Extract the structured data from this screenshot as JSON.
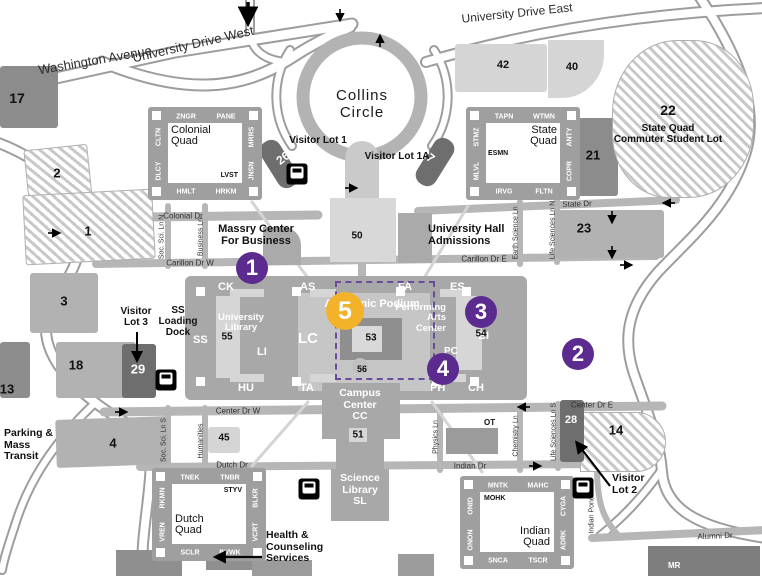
{
  "colors": {
    "road": "#b6b6b6",
    "road_casing": "#9d9d9d",
    "lot_gray": "#b2b2b2",
    "lot_dark": "#8c8c8c",
    "lot_darker": "#6e6e6e",
    "lot_light": "#d5d5d5",
    "quad": "#9f9f9f",
    "podium": "#a8a8a8",
    "podium_inner": "#c6c6c6",
    "marker_purple": "#5b2b8f",
    "marker_yellow": "#f2b32b",
    "dash": "#6a4ba0"
  },
  "road_labels": [
    {
      "text": "Washington Avenue",
      "x": 95,
      "y": 60,
      "rot": -10,
      "size": 13
    },
    {
      "text": "University Drive West",
      "x": 193,
      "y": 44,
      "rot": -13,
      "size": 13
    },
    {
      "text": "University Drive East",
      "x": 517,
      "y": 13,
      "rot": -6,
      "size": 12
    },
    {
      "text": "Colonial Dr",
      "x": 183,
      "y": 216,
      "rot": 0,
      "size": 8
    },
    {
      "text": "State Dr",
      "x": 577,
      "y": 204,
      "rot": -2,
      "size": 8
    },
    {
      "text": "Carillon Dr W",
      "x": 190,
      "y": 263,
      "rot": 0,
      "size": 8
    },
    {
      "text": "Carillon Dr E",
      "x": 484,
      "y": 259,
      "rot": 0,
      "size": 8
    },
    {
      "text": "Center Dr W",
      "x": 238,
      "y": 411,
      "rot": 0,
      "size": 8
    },
    {
      "text": "Center Dr E",
      "x": 592,
      "y": 405,
      "rot": 0,
      "size": 8
    },
    {
      "text": "Dutch Dr",
      "x": 232,
      "y": 465,
      "rot": 0,
      "size": 8
    },
    {
      "text": "Indian Dr",
      "x": 470,
      "y": 466,
      "rot": 0,
      "size": 8
    },
    {
      "text": "Alumni Dr",
      "x": 715,
      "y": 536,
      "rot": -2,
      "size": 8
    },
    {
      "text": "Soc. Sci. Ln N",
      "x": 162,
      "y": 237,
      "rot": -90,
      "size": 7
    },
    {
      "text": "Business Ln",
      "x": 201,
      "y": 237,
      "rot": -90,
      "size": 7
    },
    {
      "text": "Earth Science Ln",
      "x": 516,
      "y": 233,
      "rot": -90,
      "size": 7
    },
    {
      "text": "Life Sciences Ln N",
      "x": 553,
      "y": 230,
      "rot": -90,
      "size": 7
    },
    {
      "text": "Soc. Sci. Ln S",
      "x": 164,
      "y": 440,
      "rot": -90,
      "size": 7
    },
    {
      "text": "Humanities",
      "x": 201,
      "y": 441,
      "rot": -90,
      "size": 7
    },
    {
      "text": "Physics Ln",
      "x": 436,
      "y": 437,
      "rot": -90,
      "size": 7
    },
    {
      "text": "Chemistry Ln",
      "x": 516,
      "y": 436,
      "rot": -90,
      "size": 7
    },
    {
      "text": "Life Sciences Ln S",
      "x": 554,
      "y": 432,
      "rot": -90,
      "size": 7
    },
    {
      "text": "Indian Pond Ln",
      "x": 592,
      "y": 510,
      "rot": -90,
      "size": 7
    }
  ],
  "area_labels": [
    {
      "id": "collins-circle",
      "lines": [
        "Collins",
        "Circle"
      ],
      "x": 362,
      "y": 88,
      "size": 15,
      "weight": 500,
      "align": "center",
      "color": "#1a1a1a",
      "ls": 1
    },
    {
      "id": "visitor-lot-1",
      "lines": [
        "Visitor Lot 1"
      ],
      "x": 318,
      "y": 135,
      "size": 10,
      "weight": 700,
      "align": "center",
      "color": "#111"
    },
    {
      "id": "visitor-lot-1a",
      "lines": [
        "Visitor Lot 1A"
      ],
      "x": 397,
      "y": 151,
      "size": 10,
      "weight": 700,
      "align": "center",
      "color": "#111"
    },
    {
      "id": "massry-center",
      "lines": [
        "Massry Center",
        "For Business"
      ],
      "x": 256,
      "y": 223,
      "size": 11,
      "weight": 700,
      "align": "center",
      "color": "#111"
    },
    {
      "id": "university-hall",
      "lines": [
        "University Hall",
        "Admissions"
      ],
      "x": 428,
      "y": 223,
      "size": 11,
      "weight": 700,
      "align": "left",
      "color": "#111"
    },
    {
      "id": "campus-center",
      "lines": [
        "Campus",
        "Center",
        "CC"
      ],
      "x": 360,
      "y": 388,
      "size": 10.5,
      "weight": 700,
      "align": "center",
      "color": "#fff"
    },
    {
      "id": "science-library",
      "lines": [
        "Science",
        "Library",
        "SL"
      ],
      "x": 360,
      "y": 473,
      "size": 10.5,
      "weight": 700,
      "align": "center",
      "color": "#fff"
    },
    {
      "id": "health-counseling",
      "lines": [
        "Health &",
        "Counseling",
        "Services"
      ],
      "x": 266,
      "y": 530,
      "size": 10.5,
      "weight": 700,
      "align": "left",
      "color": "#111"
    },
    {
      "id": "parking-mass-transit",
      "lines": [
        "Parking &",
        "Mass",
        "Transit"
      ],
      "x": 4,
      "y": 428,
      "size": 10.5,
      "weight": 700,
      "align": "left",
      "color": "#111"
    },
    {
      "id": "visitor-lot-3",
      "lines": [
        "Visitor",
        "Lot 3"
      ],
      "x": 136,
      "y": 306,
      "size": 10,
      "weight": 700,
      "align": "center",
      "color": "#111"
    },
    {
      "id": "ss-loading-dock",
      "lines": [
        "SS",
        "Loading",
        "Dock"
      ],
      "x": 178,
      "y": 305,
      "size": 10,
      "weight": 700,
      "align": "center",
      "color": "#111"
    },
    {
      "id": "visitor-lot-2",
      "lines": [
        "Visitor",
        "Lot 2"
      ],
      "x": 612,
      "y": 473,
      "size": 10.5,
      "weight": 700,
      "align": "left",
      "color": "#111"
    },
    {
      "id": "state-quad-commuter-lot",
      "lines": [
        "State Quad",
        "Commuter Student Lot"
      ],
      "x": 668,
      "y": 123,
      "size": 10,
      "weight": 700,
      "align": "center",
      "color": "#111"
    },
    {
      "id": "ot-building",
      "lines": [
        "OT"
      ],
      "x": 484,
      "y": 419,
      "size": 8,
      "weight": 700,
      "align": "left",
      "color": "#111"
    },
    {
      "id": "mr-building",
      "lines": [
        "MR"
      ],
      "x": 668,
      "y": 562,
      "size": 8,
      "weight": 700,
      "align": "left",
      "color": "#fff"
    },
    {
      "id": "academic-podium",
      "lines": [
        "Academic Podium"
      ],
      "x": 372,
      "y": 298,
      "size": 11,
      "weight": 700,
      "align": "center",
      "color": "#fff"
    },
    {
      "id": "performing-arts",
      "lines": [
        "Performing",
        "Arts",
        "Center"
      ],
      "x": 446,
      "y": 303,
      "size": 9.5,
      "weight": 700,
      "align": "right",
      "color": "#fff"
    },
    {
      "id": "pc-code",
      "lines": [
        "PC"
      ],
      "x": 444,
      "y": 346,
      "size": 10,
      "weight": 700,
      "align": "left",
      "color": "#fff"
    },
    {
      "id": "university-library",
      "lines": [
        "University",
        "Library"
      ],
      "x": 241,
      "y": 313,
      "size": 9.5,
      "weight": 700,
      "align": "center",
      "color": "#fff"
    }
  ],
  "numbers": [
    {
      "t": "17",
      "x": 17,
      "y": 98,
      "s": 14
    },
    {
      "t": "2",
      "x": 57,
      "y": 173,
      "s": 13
    },
    {
      "t": "1",
      "x": 88,
      "y": 231,
      "s": 13
    },
    {
      "t": "3",
      "x": 64,
      "y": 301,
      "s": 13
    },
    {
      "t": "13",
      "x": 7,
      "y": 389,
      "s": 13
    },
    {
      "t": "18",
      "x": 76,
      "y": 365,
      "s": 13
    },
    {
      "t": "29",
      "x": 138,
      "y": 369,
      "s": 13,
      "c": "#fff"
    },
    {
      "t": "4",
      "x": 113,
      "y": 443,
      "s": 13
    },
    {
      "t": "45",
      "x": 224,
      "y": 438,
      "s": 10
    },
    {
      "t": "42",
      "x": 503,
      "y": 65,
      "s": 11
    },
    {
      "t": "40",
      "x": 572,
      "y": 67,
      "s": 11
    },
    {
      "t": "21",
      "x": 593,
      "y": 155,
      "s": 13
    },
    {
      "t": "22",
      "x": 668,
      "y": 110,
      "s": 14
    },
    {
      "t": "23",
      "x": 584,
      "y": 228,
      "s": 13
    },
    {
      "t": "14",
      "x": 616,
      "y": 430,
      "s": 13
    },
    {
      "t": "28",
      "x": 571,
      "y": 420,
      "s": 11,
      "c": "#fff"
    },
    {
      "t": "26",
      "x": 283,
      "y": 158,
      "s": 12,
      "c": "#fff",
      "rot": -38
    },
    {
      "t": "27",
      "x": 428,
      "y": 156,
      "s": 12,
      "c": "#fff",
      "rot": 38
    },
    {
      "t": "50",
      "x": 357,
      "y": 236,
      "s": 10
    },
    {
      "t": "51",
      "x": 358,
      "y": 435,
      "s": 10
    },
    {
      "t": "53",
      "x": 371,
      "y": 338,
      "s": 10
    },
    {
      "t": "54",
      "x": 481,
      "y": 334,
      "s": 10
    },
    {
      "t": "55",
      "x": 227,
      "y": 337,
      "s": 10
    },
    {
      "t": "56",
      "x": 362,
      "y": 369,
      "s": 9
    }
  ],
  "quads": [
    {
      "id": "colonial-quad",
      "name": "Colonial Quad",
      "x": 148,
      "y": 107,
      "top": [
        "ZNGR",
        "PANE"
      ],
      "left": [
        "CLTN",
        "DLCY"
      ],
      "right": [
        "MRRS",
        "JNSN"
      ],
      "bottom": [
        "HMLT",
        "HRKM"
      ],
      "inner_code": "LVST",
      "name_pos": "tl",
      "code_pos": "br"
    },
    {
      "id": "state-quad",
      "name": "State Quad",
      "x": 466,
      "y": 107,
      "top": [
        "TAPN",
        "WTMN"
      ],
      "left": [
        "STMZ",
        "MLVL"
      ],
      "right": [
        "ANTY",
        "COPR"
      ],
      "bottom": [
        "IRVG",
        "FLTN"
      ],
      "inner_code": "ESMN",
      "name_pos": "tr",
      "code_pos": "ml"
    },
    {
      "id": "dutch-quad",
      "name": "Dutch Quad",
      "x": 152,
      "y": 468,
      "top": [
        "TNEK",
        "TNBR"
      ],
      "left": [
        "RKMN",
        "VREN"
      ],
      "right": [
        "BLKR",
        "VCRT"
      ],
      "bottom": [
        "SCLR",
        "BVWK"
      ],
      "inner_code": "STYV",
      "name_pos": "bl",
      "code_pos": "tr"
    },
    {
      "id": "indian-quad",
      "name": "Indian Quad",
      "x": 460,
      "y": 476,
      "top": [
        "MNTK",
        "MAHC"
      ],
      "left": [
        "ONID",
        "ONON"
      ],
      "right": [
        "CYGA",
        "ADRK"
      ],
      "bottom": [
        "SNCA",
        "TSCR"
      ],
      "inner_code": "MOHK",
      "name_pos": "br",
      "code_pos": "tl"
    }
  ],
  "podium_labels": [
    {
      "t": "CK",
      "x": 218,
      "y": 281
    },
    {
      "t": "AS",
      "x": 300,
      "y": 281
    },
    {
      "t": "FA",
      "x": 398,
      "y": 281
    },
    {
      "t": "ES",
      "x": 450,
      "y": 281
    },
    {
      "t": "SS",
      "x": 193,
      "y": 334
    },
    {
      "t": "LC",
      "x": 298,
      "y": 330,
      "s": 15
    },
    {
      "t": "BI",
      "x": 478,
      "y": 330
    },
    {
      "t": "LI",
      "x": 257,
      "y": 346
    },
    {
      "t": "HU",
      "x": 238,
      "y": 382
    },
    {
      "t": "TA",
      "x": 300,
      "y": 382
    },
    {
      "t": "PH",
      "x": 430,
      "y": 382
    },
    {
      "t": "CH",
      "x": 468,
      "y": 382
    }
  ],
  "lots": [
    {
      "id": "17",
      "x": 0,
      "y": 66,
      "w": 58,
      "h": 62,
      "style": "dark"
    },
    {
      "id": "2",
      "x": 26,
      "y": 147,
      "w": 64,
      "h": 54,
      "style": "hatched",
      "rot": -6
    },
    {
      "id": "1",
      "x": 24,
      "y": 192,
      "w": 130,
      "h": 70,
      "style": "hatched",
      "rot": -3
    },
    {
      "id": "3",
      "x": 30,
      "y": 273,
      "w": 68,
      "h": 60,
      "style": "gray"
    },
    {
      "id": "13",
      "x": 0,
      "y": 342,
      "w": 30,
      "h": 56,
      "style": "dark"
    },
    {
      "id": "18",
      "x": 56,
      "y": 342,
      "w": 80,
      "h": 56,
      "style": "gray"
    },
    {
      "id": "29",
      "x": 122,
      "y": 344,
      "w": 34,
      "h": 54,
      "style": "darker"
    },
    {
      "id": "4",
      "x": 56,
      "y": 418,
      "w": 112,
      "h": 48,
      "style": "gray",
      "rot": -2
    },
    {
      "id": "45",
      "x": 208,
      "y": 427,
      "w": 32,
      "h": 26,
      "style": "light"
    },
    {
      "id": "42",
      "x": 455,
      "y": 44,
      "w": 92,
      "h": 48,
      "style": "light"
    },
    {
      "id": "40",
      "x": 548,
      "y": 40,
      "w": 56,
      "h": 58,
      "style": "light",
      "r": "0 0 75% 0"
    },
    {
      "id": "21",
      "x": 572,
      "y": 118,
      "w": 46,
      "h": 78,
      "style": "dark"
    },
    {
      "id": "22",
      "x": 612,
      "y": 40,
      "w": 142,
      "h": 158,
      "style": "hatched",
      "r": "46% 42% 46% 40%"
    },
    {
      "id": "23",
      "x": 556,
      "y": 210,
      "w": 108,
      "h": 48,
      "style": "gray"
    },
    {
      "id": "14",
      "x": 580,
      "y": 412,
      "w": 86,
      "h": 60,
      "style": "hatched",
      "r": "0 30px 30px 0"
    },
    {
      "id": "28",
      "x": 560,
      "y": 400,
      "w": 24,
      "h": 62,
      "style": "darker"
    },
    {
      "id": "26",
      "x": 268,
      "y": 138,
      "w": 22,
      "h": 52,
      "style": "darker",
      "rot": -32,
      "r": "10px"
    },
    {
      "id": "27",
      "x": 424,
      "y": 136,
      "w": 22,
      "h": 52,
      "style": "darker",
      "rot": 32,
      "r": "10px"
    }
  ],
  "markers": [
    {
      "n": "1",
      "x": 252,
      "y": 268,
      "r": 16,
      "color": "purple"
    },
    {
      "n": "2",
      "x": 578,
      "y": 354,
      "r": 16,
      "color": "purple"
    },
    {
      "n": "3",
      "x": 481,
      "y": 312,
      "r": 16,
      "color": "purple"
    },
    {
      "n": "4",
      "x": 443,
      "y": 369,
      "r": 16,
      "color": "purple"
    },
    {
      "n": "5",
      "x": 345,
      "y": 311,
      "r": 19,
      "color": "yellow"
    }
  ],
  "dashed_box": {
    "x": 335,
    "y": 281,
    "w": 96,
    "h": 95
  },
  "bus_stops": [
    {
      "x": 297,
      "y": 174
    },
    {
      "x": 166,
      "y": 380
    },
    {
      "x": 309,
      "y": 489
    },
    {
      "x": 583,
      "y": 488
    }
  ],
  "small_arrows": [
    {
      "x": 55,
      "y": 233,
      "a": 0
    },
    {
      "x": 122,
      "y": 412,
      "a": 0
    },
    {
      "x": 523,
      "y": 407,
      "a": 180
    },
    {
      "x": 536,
      "y": 466,
      "a": 0
    },
    {
      "x": 668,
      "y": 203,
      "a": 180
    },
    {
      "x": 612,
      "y": 218,
      "a": 90
    },
    {
      "x": 612,
      "y": 253,
      "a": 90
    },
    {
      "x": 627,
      "y": 265,
      "a": 0
    },
    {
      "x": 352,
      "y": 188,
      "a": 0
    },
    {
      "x": 340,
      "y": 16,
      "a": 90
    },
    {
      "x": 380,
      "y": 40,
      "a": -90
    }
  ],
  "big_arrows": [
    {
      "x1": 137,
      "y1": 332,
      "x2": 137,
      "y2": 360,
      "w": 2
    },
    {
      "x1": 610,
      "y1": 486,
      "x2": 577,
      "y2": 443,
      "w": 2.2
    },
    {
      "x1": 262,
      "y1": 557,
      "x2": 216,
      "y2": 557,
      "w": 2.2
    },
    {
      "x1": 248,
      "y1": 2,
      "x2": 248,
      "y2": 22,
      "w": 3.5
    }
  ]
}
